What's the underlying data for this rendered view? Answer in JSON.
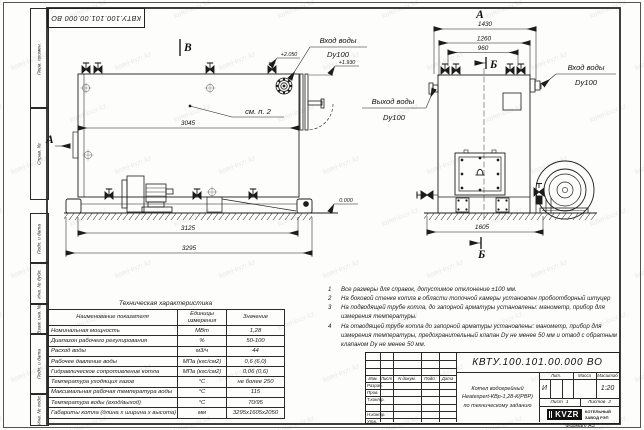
{
  "watermark": "kotel-kvzr.kz",
  "stamp_doc_number": "КВТУ.100.101.00.000  ВО",
  "frame": {
    "top_labels": [
      "Перв. примен.",
      "Справ. №"
    ],
    "bottom_labels": [
      "Подп. и дата",
      "Инв. № дубл.",
      "Взам. инв. №",
      "Подп. и дата",
      "Инв. № подл."
    ],
    "format_label": "Формат А3"
  },
  "views": {
    "side": {
      "label": "В",
      "dir_label": "А",
      "see_note": "см. п. 2",
      "dims": {
        "inner": "3045",
        "base": "3125",
        "overall": "3295"
      },
      "elevations": {
        "top": "+2.050",
        "pipe": "+1.930",
        "zero": "0.000"
      },
      "inlet_label": "Вход воды",
      "inlet_dn": "Dy100"
    },
    "front": {
      "label": "А",
      "section_label": "Б",
      "dims": {
        "overall": "1430",
        "mid": "1260",
        "valves": "960",
        "base": "1605"
      },
      "inlet_label": "Вход воды",
      "inlet_dn": "Dy100",
      "outlet_label": "Выход воды",
      "outlet_dn": "Dy100"
    }
  },
  "notes": {
    "items": [
      {
        "num": "1",
        "text": "Все размеры для справок, допустимое отклонение ±100 мм."
      },
      {
        "num": "2",
        "text": "На боковой стенке котла в области топочной камеры установлен пробоотборный штуцер"
      },
      {
        "num": "3",
        "text": "На подводящей трубе котла, до запорной арматуры установлены: манометр, прибор для измерения температуры."
      },
      {
        "num": "4",
        "text": "На отводящей трубе котла до запорной арматуры установлены: манометр, прибор для измерения температуры, предохранительный клапан Dу не менее 50 мм и отвод с обратным клапаном Dу не менее 50 мм."
      }
    ]
  },
  "tech_table": {
    "title": "Техническая характеристика",
    "headers": [
      "Наименование показателя",
      "Единицы измерения",
      "Значение"
    ],
    "rows": [
      [
        "Номинальная мощность",
        "МВт",
        "1,28"
      ],
      [
        "Диапазон рабочего регулирования",
        "%",
        "50-100"
      ],
      [
        "Расход воды",
        "м3/ч",
        "44"
      ],
      [
        "Рабочее давление воды",
        "МПа (кгс/см2)",
        "0,6 (6,0)"
      ],
      [
        "Гидравлическое сопротивление котла",
        "МПа (кгс/см2)",
        "0,06 (0,6)"
      ],
      [
        "Температура уходящих газов",
        "°С",
        "не более 250"
      ],
      [
        "Максимальная рабочая температура воды",
        "°С",
        "115"
      ],
      [
        "Температура воды (вход/выход)",
        "°С",
        "70/95"
      ],
      [
        "Габариты котла (длина х ширина х высота)",
        "мм",
        "3295х1605х2050"
      ]
    ]
  },
  "title_block": {
    "doc_number": "КВТУ.100.101.00.000  ВО",
    "description_lines": [
      "Котел водогрейный",
      "Heatexpert-КВр-1,28-К(РВР)",
      "по техническому заданию"
    ],
    "columns": [
      "Изм.",
      "Лист",
      "N докум.",
      "Подп.",
      "Дата"
    ],
    "rows": [
      "Разраб.",
      "Пров.",
      "Т.контр.",
      "Н.контр.",
      "Утв."
    ],
    "lit_label": "Лит.",
    "lit_value": "И",
    "mass_label": "Масса",
    "scale_label": "Масштаб",
    "scale_value": "1:20",
    "sheet_label": "Лист",
    "sheet_value": "1",
    "sheets_label": "Листов",
    "sheets_value": "2",
    "logo_text": "KVZR",
    "company_lines": [
      "КОТЕЛЬНЫЙ",
      "ЗАВОД РЭП"
    ]
  }
}
